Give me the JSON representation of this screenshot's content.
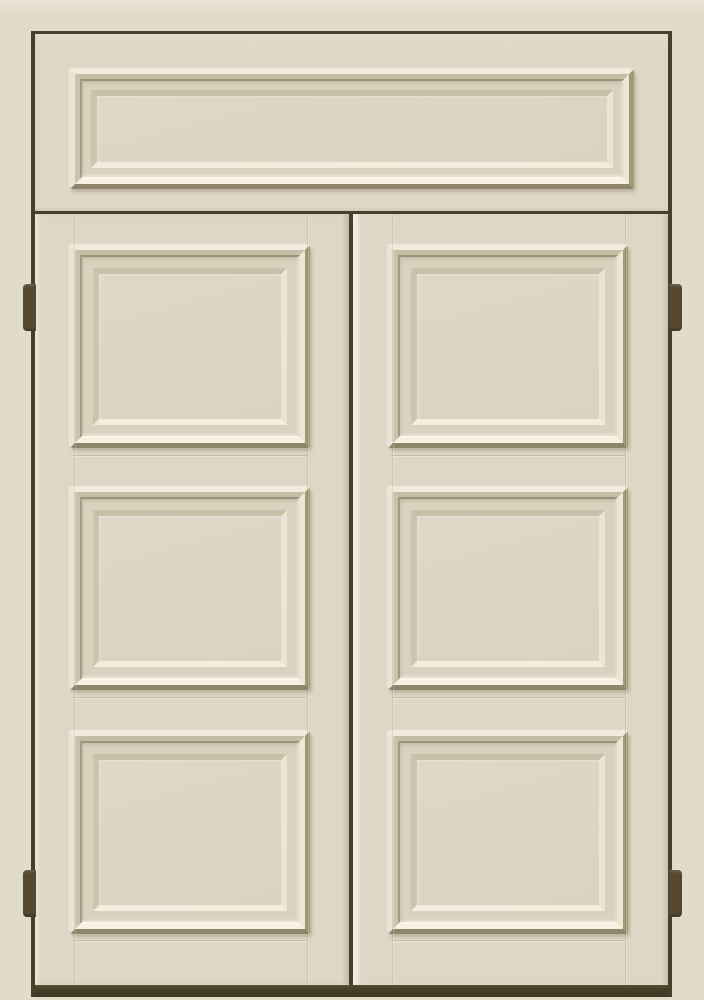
{
  "scene": {
    "description": "Classic cream-painted double door with a paneled transom above, six raised bolection panels (three per leaf), dark bronze butt hinges on both jambs and a dark threshold at the bottom.",
    "object": "double panel door with transom",
    "style": "traditional raised-panel joinery",
    "finish_color_name": "antique cream / ivory",
    "hardware_color_name": "dark oil-rubbed bronze"
  },
  "door": {
    "leaves": 2,
    "panels_per_leaf": 3,
    "transom_panels": 1,
    "hinge_count": 4
  },
  "palette": {
    "wall": "#E1DBC9",
    "wall-light": "#EAE5D5",
    "door-surface": "#DED7C5",
    "panel-field": "#DCD5C2",
    "recess": "#D9D2BF",
    "highlight": "#F5F0E0",
    "shadow-mid": "#A39976",
    "shadow-deep": "#8F856B",
    "outline": "#473E2B",
    "threshold": "#4A4129",
    "hinge": "#56492E"
  }
}
